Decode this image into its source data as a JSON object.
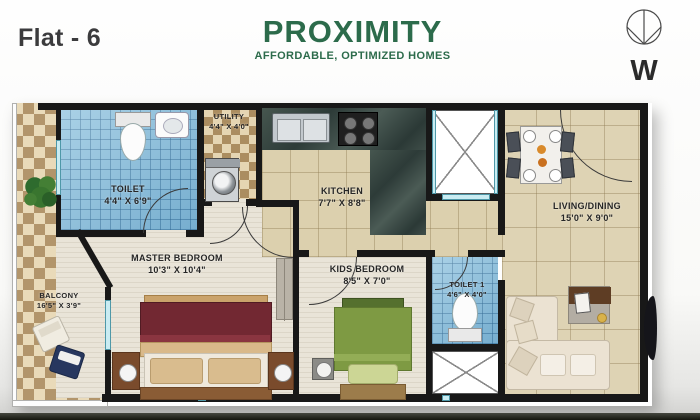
{
  "header": {
    "flat_label": "Flat - 6",
    "brand_name": "PROXIMITY",
    "tagline": "AFFORDABLE, OPTIMIZED HOMES",
    "compass_letter": "W"
  },
  "colors": {
    "brand_green": "#2c6b4b",
    "wall_black": "#181818",
    "toilet_tile_blue": "#8ac0dd",
    "floor_beige": "#dcd0ae",
    "balcony_checker_dark": "#b2956b",
    "balcony_checker_light": "#e9dab9",
    "counter_granite": "#3c4b47",
    "window_teal": "#c9ecf2"
  },
  "rooms": {
    "toilet": {
      "name": "TOILET",
      "dims": "4'4\" X 6'9\""
    },
    "utility": {
      "name": "UTILITY",
      "dims": "4'4\" X 4'0\""
    },
    "kitchen": {
      "name": "KITCHEN",
      "dims": "7'7\" X 8'8\""
    },
    "master_bedroom": {
      "name": "MASTER BEDROOM",
      "dims": "10'3\" X 10'4\""
    },
    "kids_bedroom": {
      "name": "KIDS BEDROOM",
      "dims": "8'5\" X 7'0\""
    },
    "toilet1": {
      "name": "TOILET 1",
      "dims": "4'6\" X 4'0\""
    },
    "living_dining": {
      "name": "LIVING/DINING",
      "dims": "15'0\" X 9'0\""
    },
    "balcony": {
      "name": "BALCONY",
      "dims": "16'5\" X 3'9\""
    }
  }
}
